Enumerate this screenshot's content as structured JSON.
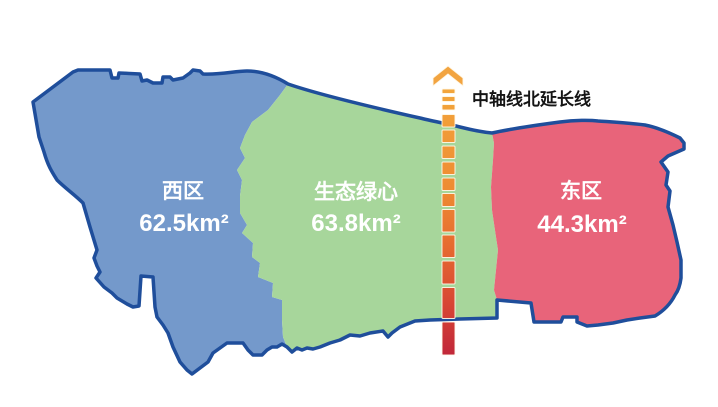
{
  "background": "#FFFFFF",
  "outline_color": "#1F4E9B",
  "label_text_color": "#FFFFFF",
  "regions": {
    "west": {
      "name": "西区",
      "area": "62.5km²",
      "fill": "#7499CB"
    },
    "center": {
      "name": "生态绿心",
      "area": "63.8km²",
      "fill": "#A7D69B"
    },
    "east": {
      "name": "东区",
      "area": "44.3km²",
      "fill": "#E8647A"
    }
  },
  "axis": {
    "label": "中轴线北延长线",
    "label_color": "#151515",
    "arrow_color": "#F2A440",
    "gradient": {
      "top": "#F4AC3E",
      "upper_mid": "#EE8C33",
      "mid": "#E66B30",
      "lower_mid": "#D74634",
      "bottom": "#C1273A"
    }
  }
}
